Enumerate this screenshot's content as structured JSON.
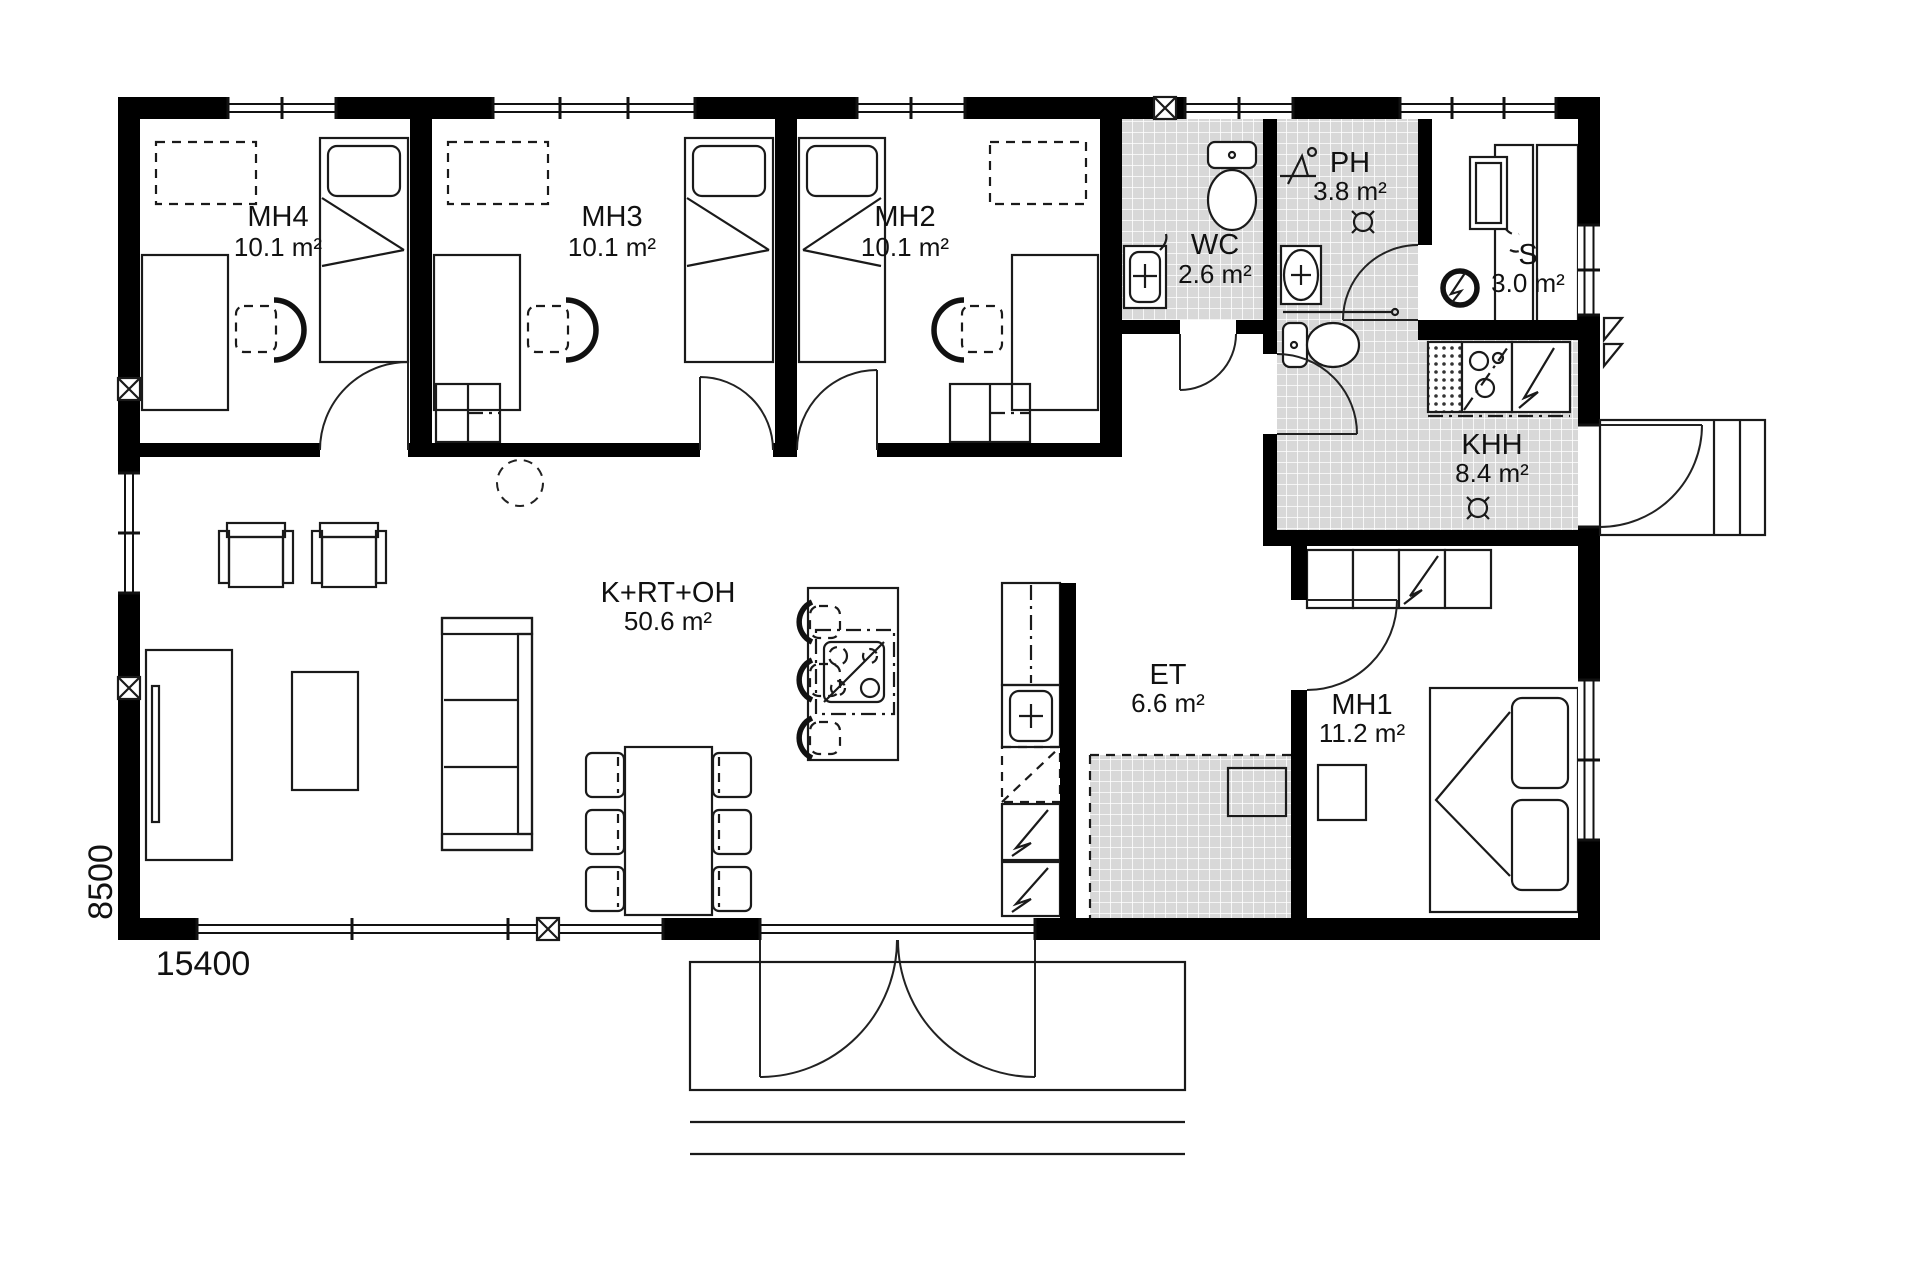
{
  "plan": {
    "title": "floor-plan",
    "rooms": [
      {
        "id": "mh4",
        "name": "MH4",
        "area": "10.1 m²"
      },
      {
        "id": "mh3",
        "name": "MH3",
        "area": "10.1 m²"
      },
      {
        "id": "mh2",
        "name": "MH2",
        "area": "10.1 m²"
      },
      {
        "id": "wc",
        "name": "WC",
        "area": "2.6 m²"
      },
      {
        "id": "ph",
        "name": "PH",
        "area": "3.8 m²"
      },
      {
        "id": "s",
        "name": "S",
        "area": "3.0 m²"
      },
      {
        "id": "khh",
        "name": "KHH",
        "area": "8.4 m²"
      },
      {
        "id": "krtoh",
        "name": "K+RT+OH",
        "area": "50.6 m²"
      },
      {
        "id": "et",
        "name": "ET",
        "area": "6.6 m²"
      },
      {
        "id": "mh1",
        "name": "MH1",
        "area": "11.2 m²"
      }
    ],
    "dimensions": {
      "bottom": "15400",
      "left": "8500"
    },
    "colors": {
      "wall": "#000000",
      "tile": "#d8d8d8",
      "line": "#1a1a1a",
      "background": "#ffffff"
    }
  }
}
